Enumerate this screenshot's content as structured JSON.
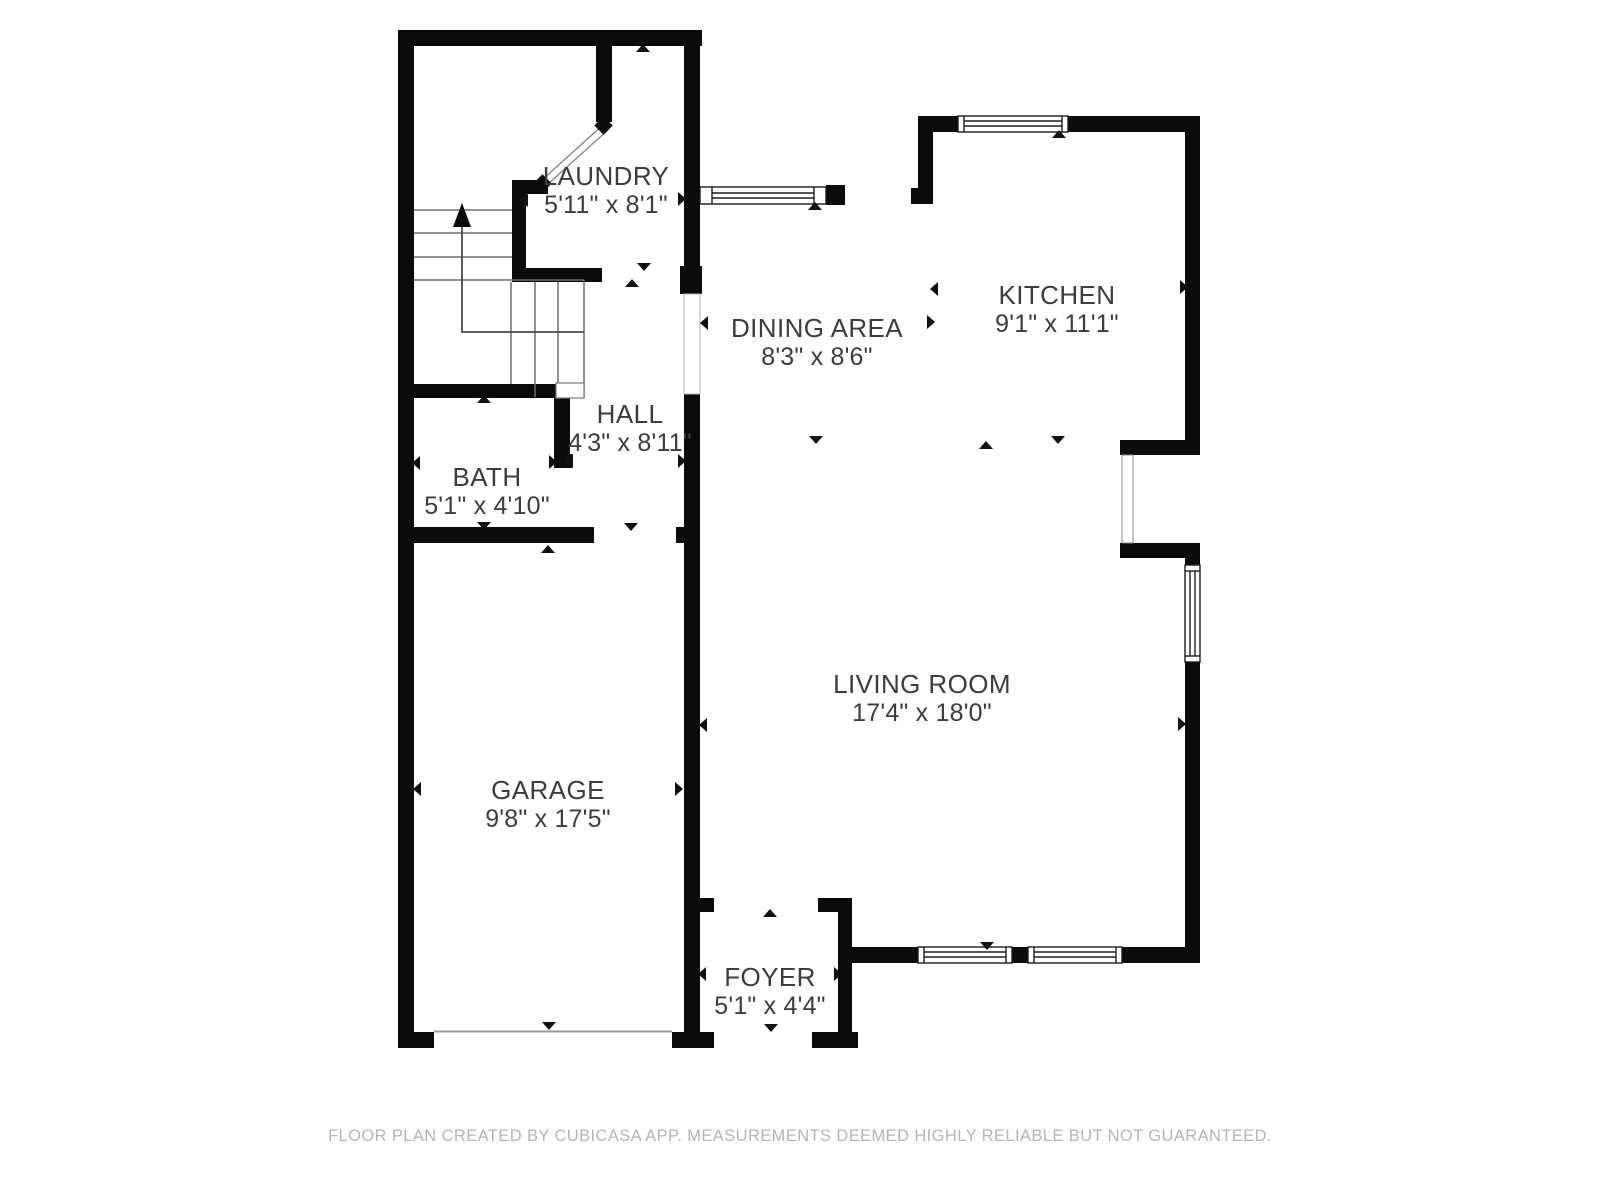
{
  "plan": {
    "title": "First floor plan",
    "footer": "FLOOR PLAN CREATED BY CUBICASA APP. MEASUREMENTS DEEMED HIGHLY RELIABLE BUT NOT GUARANTEED.",
    "wall_color": "#0b0b0b",
    "rooms": {
      "laundry": {
        "name": "LAUNDRY",
        "dimensions": "5'11\" x 8'1\""
      },
      "dining": {
        "name": "DINING AREA",
        "dimensions": "8'3\" x 8'6\""
      },
      "kitchen": {
        "name": "KITCHEN",
        "dimensions": "9'1\" x 11'1\""
      },
      "hall": {
        "name": "HALL",
        "dimensions": "4'3\" x 8'11\""
      },
      "bath": {
        "name": "BATH",
        "dimensions": "5'1\" x 4'10\""
      },
      "garage": {
        "name": "GARAGE",
        "dimensions": "9'8\" x 17'5\""
      },
      "living": {
        "name": "LIVING ROOM",
        "dimensions": "17'4\" x 18'0\""
      },
      "foyer": {
        "name": "FOYER",
        "dimensions": "5'1\" x 4'4\""
      }
    }
  }
}
